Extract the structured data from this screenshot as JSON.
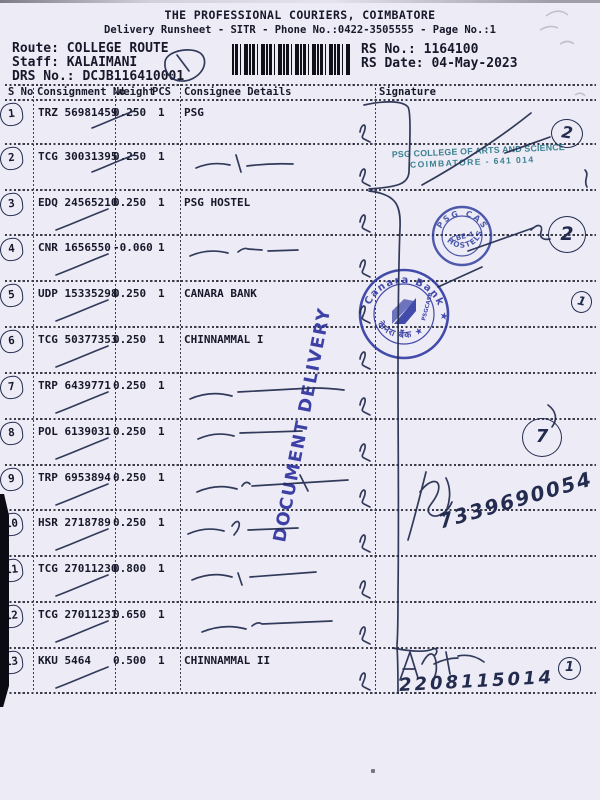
{
  "header": {
    "title": "THE PROFESSIONAL COURIERS, COIMBATORE",
    "subtitle": "Delivery Runsheet - SITR - Phone No.:0422-3505555 - Page No.:1",
    "route_label": "Route: ",
    "route": "COLLEGE ROUTE",
    "staff_label": "Staff: ",
    "staff": "KALAIMANI",
    "drs_label": "DRS No.: ",
    "drs": "DCJB116410001",
    "rs_no_label": "RS No.: ",
    "rs_no": "1164100",
    "rs_date_label": "RS Date: ",
    "rs_date": "04-May-2023"
  },
  "table": {
    "headers": {
      "sno": "S No",
      "consignment": "Consignment No",
      "weight": "Weight",
      "pcs": "PCS",
      "consignee": "Consignee Details",
      "signature": "Signature"
    },
    "rows": [
      {
        "sno": "1",
        "consignment": "TRZ 56981459",
        "weight": "0.250",
        "pcs": "1",
        "consignee": "PSG"
      },
      {
        "sno": "2",
        "consignment": "TCG 30031395",
        "weight": "0.250",
        "pcs": "1",
        "consignee": ""
      },
      {
        "sno": "3",
        "consignment": "EDQ 24565210",
        "weight": "0.250",
        "pcs": "1",
        "consignee": "PSG HOSTEL"
      },
      {
        "sno": "4",
        "consignment": "CNR 1656550",
        "weight": "-0.060",
        "pcs": "1",
        "consignee": ""
      },
      {
        "sno": "5",
        "consignment": "UDP 15335298",
        "weight": "0.250",
        "pcs": "1",
        "consignee": "CANARA BANK"
      },
      {
        "sno": "6",
        "consignment": "TCG 50377353",
        "weight": "0.250",
        "pcs": "1",
        "consignee": "CHINNAMMAL I"
      },
      {
        "sno": "7",
        "consignment": "TRP 6439771",
        "weight": "0.250",
        "pcs": "1",
        "consignee": ""
      },
      {
        "sno": "8",
        "consignment": "POL 6139031",
        "weight": "0.250",
        "pcs": "1",
        "consignee": ""
      },
      {
        "sno": "9",
        "consignment": "TRP 6953894",
        "weight": "0.250",
        "pcs": "1",
        "consignee": ""
      },
      {
        "sno": "10",
        "consignment": "HSR 2718789",
        "weight": "0.250",
        "pcs": "1",
        "consignee": ""
      },
      {
        "sno": "11",
        "consignment": "TCG 27011230",
        "weight": "0.800",
        "pcs": "1",
        "consignee": ""
      },
      {
        "sno": "12",
        "consignment": "TCG 27011231",
        "weight": "0.650",
        "pcs": "1",
        "consignee": ""
      },
      {
        "sno": "13",
        "consignment": "KKU 5464",
        "weight": "0.500",
        "pcs": "1",
        "consignee": "CHINNAMMAL II"
      }
    ]
  },
  "stamps": {
    "psg_college": {
      "line1": "PSG COLLEGE OF ARTS AND SCIENCE",
      "line2": "COIMBATORE - 641 014"
    },
    "psg_hostel": {
      "ring_top": "PSG CAS",
      "ring_bottom": "HOSTELS",
      "center": "CBE-4"
    },
    "canara": {
      "ring_top": "Canara Bank ★",
      "ring_bottom": "केनरा बैंक ★",
      "small_text": "PSGCASB"
    },
    "document_delivery": "DOCUMENT DELIVERY"
  },
  "annotations": {
    "circled": [
      "2",
      "2",
      "1",
      "7",
      "1"
    ],
    "phone1": "7339690054",
    "phone2": "2208115014"
  }
}
